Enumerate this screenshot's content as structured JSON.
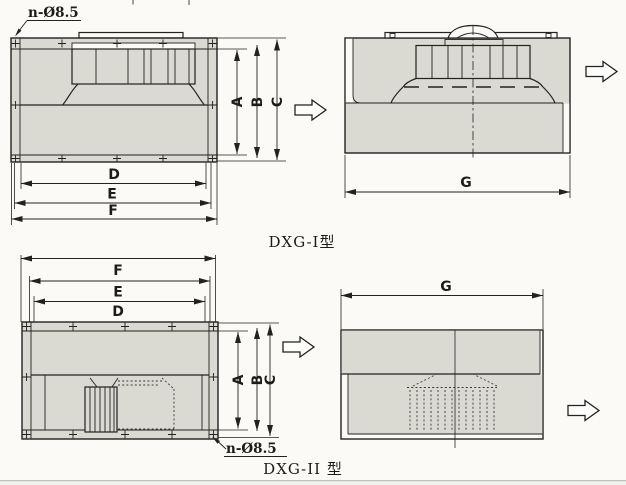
{
  "drawing": {
    "background": "#fbfaf7",
    "ink": "#232220",
    "panel_fill": "#dad9d2",
    "models": {
      "dxg1": {
        "caption": "DXG-I型",
        "hole_label": "n-Ø8.5",
        "dim_a": "A",
        "dim_b": "B",
        "dim_c": "C",
        "dim_d": "D",
        "dim_e": "E",
        "dim_f": "F",
        "dim_g": "G"
      },
      "dxg2": {
        "caption": "DXG-II 型",
        "hole_label": "n-Ø8.5",
        "dim_a": "A",
        "dim_b": "B",
        "dim_c": "C",
        "dim_d": "D",
        "dim_e": "E",
        "dim_f": "F",
        "dim_g": "G"
      }
    }
  }
}
